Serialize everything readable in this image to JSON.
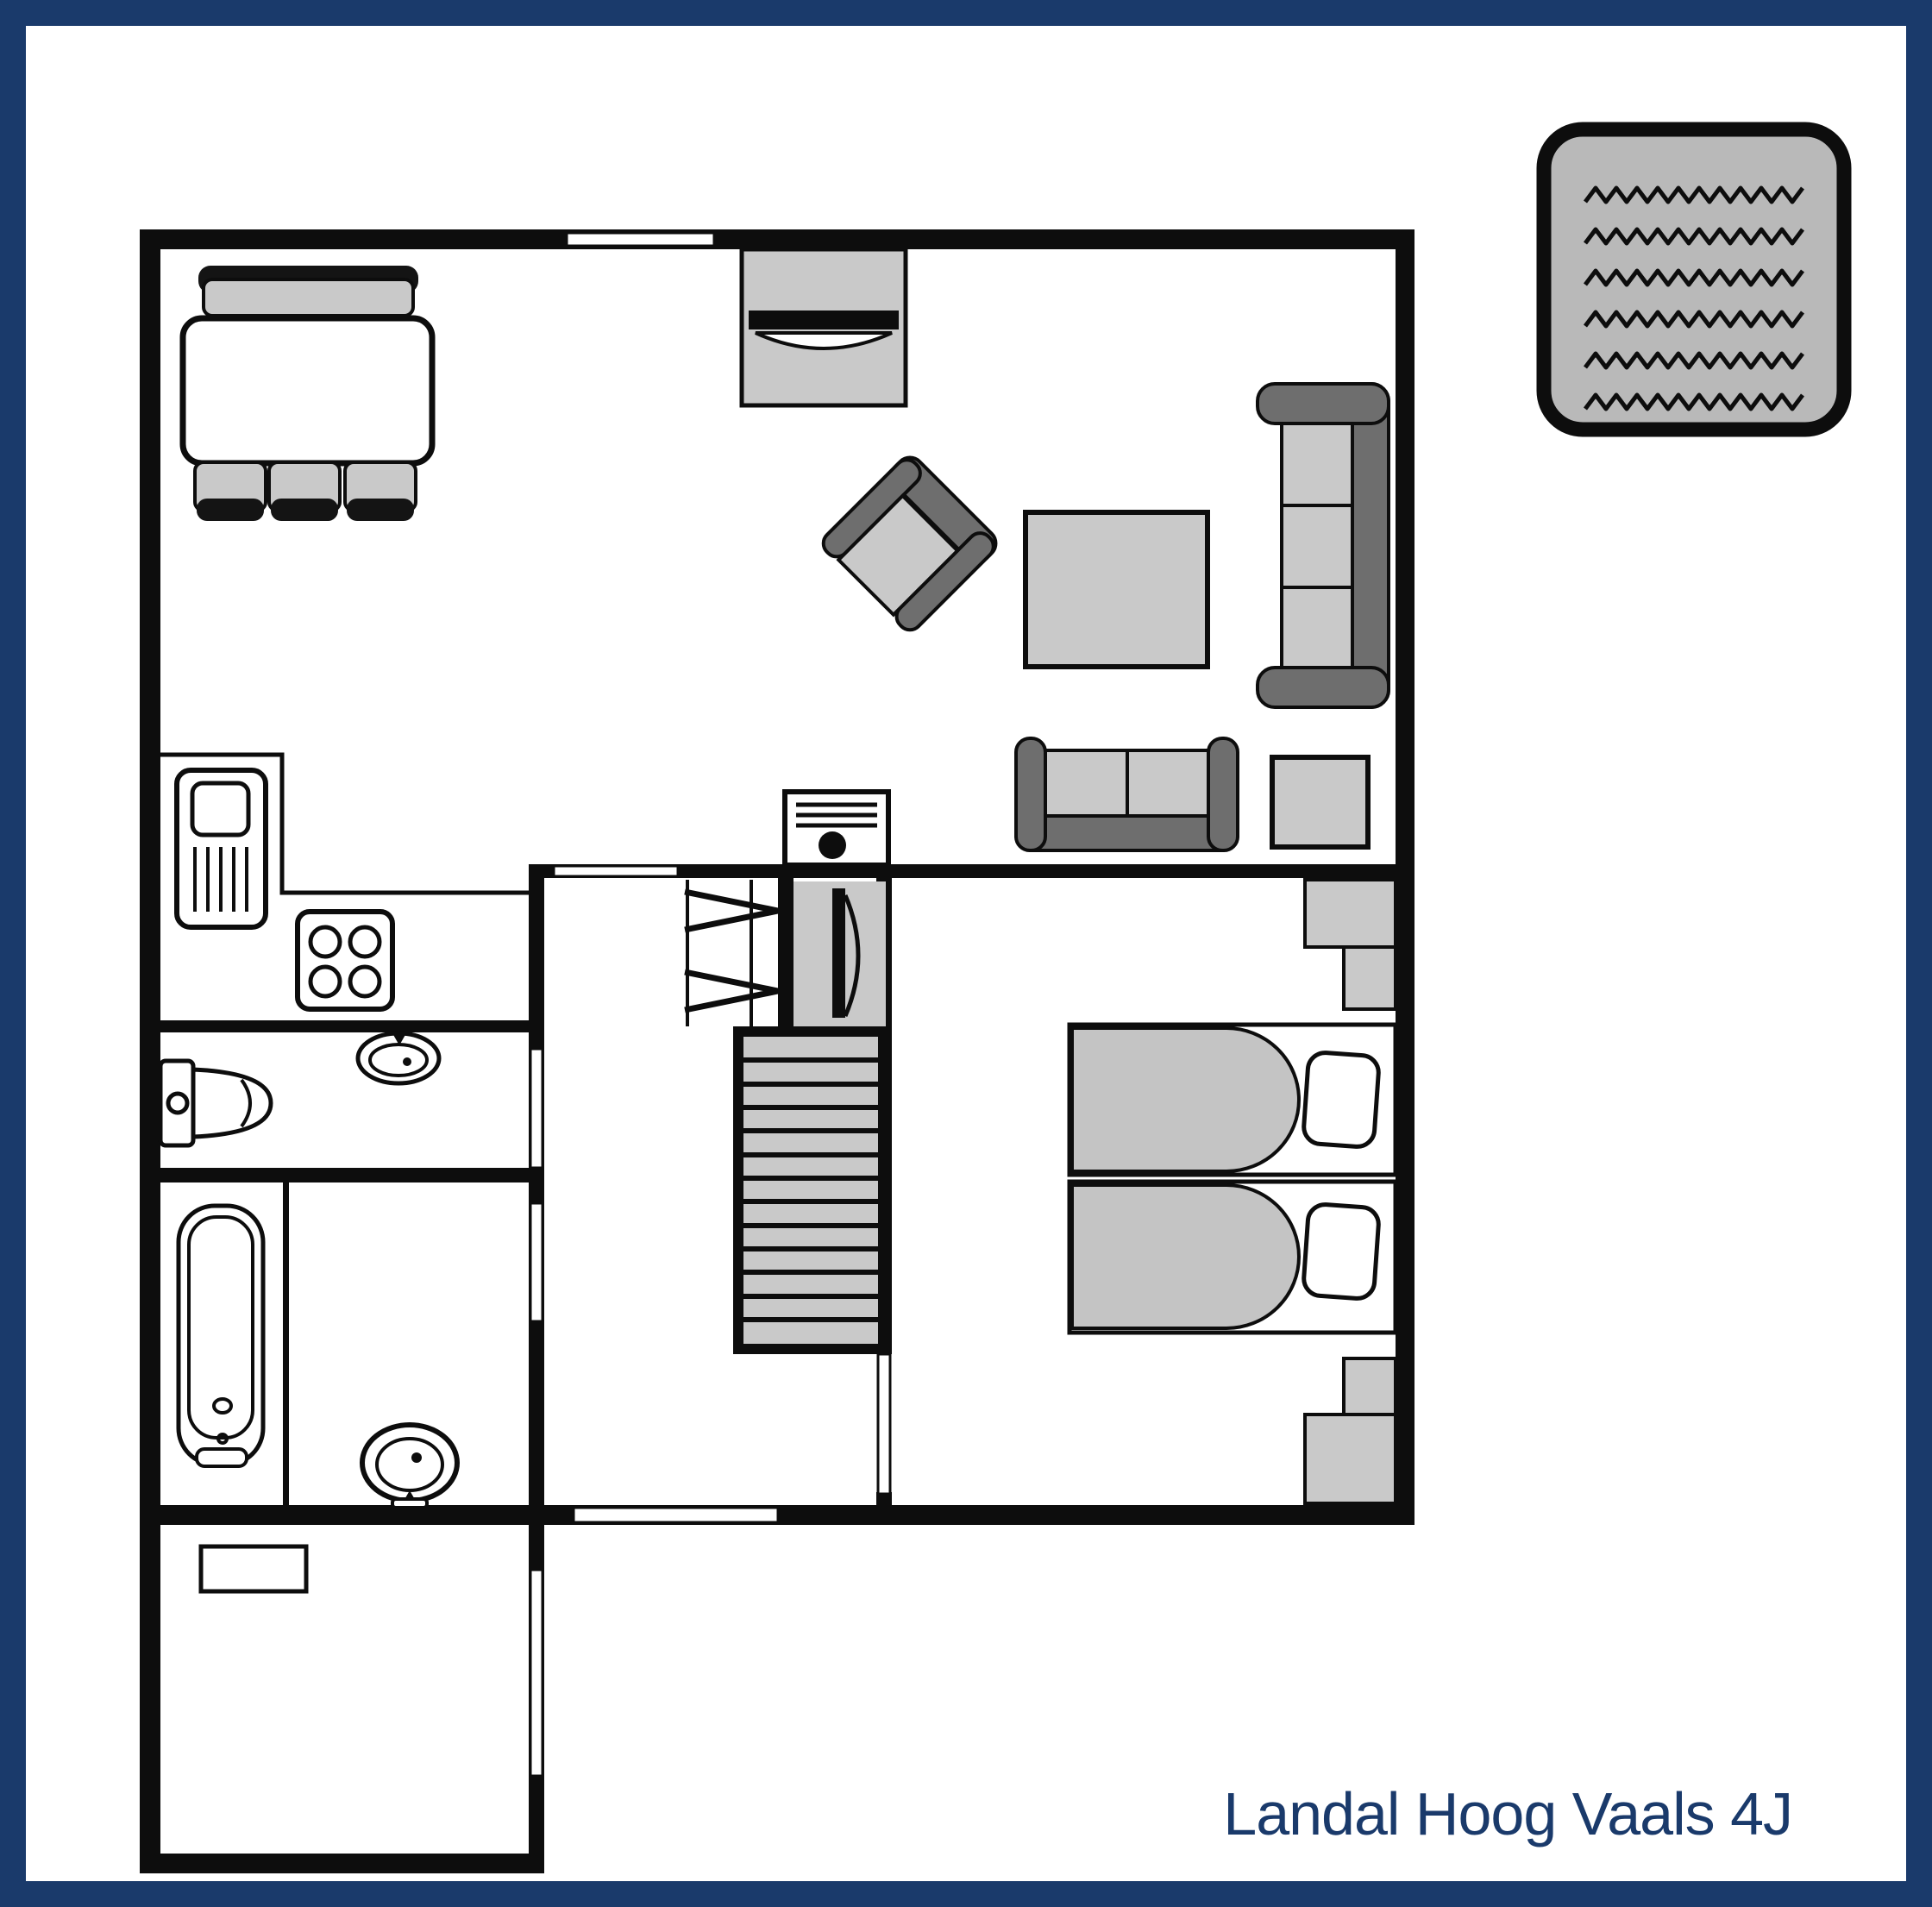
{
  "title": {
    "text": "Landal Hoog Vaals 4J"
  },
  "colors": {
    "frame_navy": "#1a3a6b",
    "wall": "#0d0d0d",
    "light": "#c9c9c9",
    "dark": "#6e6e6e",
    "duvet": "#c4c4c4",
    "tubgray": "#b9b9b9",
    "bg": "#ffffff"
  },
  "furniture_icons": [
    "dining-bench-icon",
    "dining-table-icon",
    "dining-chair-icon",
    "tv-sideboard-icon",
    "armchair-icon",
    "sofa-3seat-icon",
    "sofa-2seat-icon",
    "coffee-table-icon",
    "side-table-icon",
    "fireplace-stove-icon",
    "fridge-icon",
    "stove-hob-icon",
    "kitchen-counter-icon",
    "toilet-icon",
    "washbasin-icon",
    "bathtub-icon",
    "staircase-icon",
    "door-icon",
    "stair-direction-chevrons-icon",
    "single-bed-icon",
    "pillow-icon",
    "wardrobe-cabinet-icon",
    "doormat-icon",
    "hot-tub-icon",
    "window-icon",
    "door-opening-icon"
  ]
}
